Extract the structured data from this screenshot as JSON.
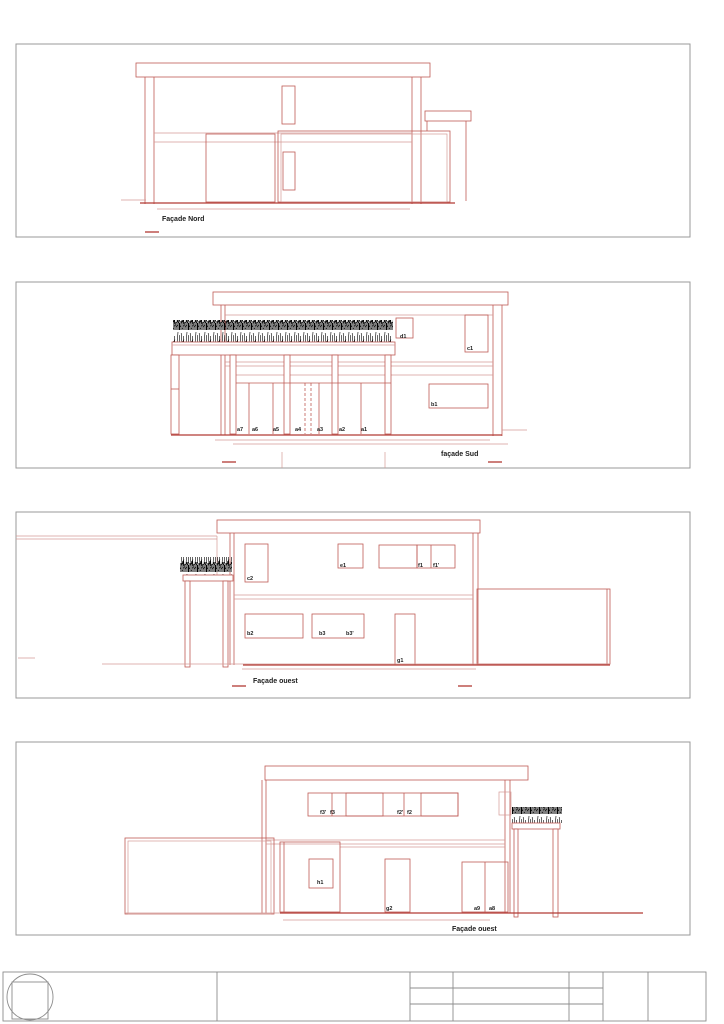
{
  "sheet": {
    "type": "architectural-elevation-drawing",
    "page": "facades"
  },
  "colors": {
    "line-red": "#bf5b55",
    "line-red-light": "#d49a96",
    "line-red-strong": "#b23a34",
    "frame-gray": "#9a9a9a",
    "titleblock-gray": "#8c8c8c",
    "ink": "#1c1c1c",
    "vegetation": "#000000"
  },
  "panels": [
    {
      "title": "Façade Nord"
    },
    {
      "title": "façade Sud",
      "labels": {
        "a": [
          "a7",
          "a6",
          "a5",
          "a4",
          "a3",
          "a2",
          "a1"
        ],
        "d1": "d1",
        "c1": "c1",
        "b1": "b1"
      }
    },
    {
      "title": "Façade ouest",
      "labels": {
        "c2": "c2",
        "e1": "e1",
        "f1": "f1",
        "f1p": "f1'",
        "b2": "b2",
        "b3": "b3",
        "b3p": "b3'",
        "g1": "g1"
      }
    },
    {
      "title": "Façade ouest",
      "labels": {
        "f3p": "f3'",
        "f3": "f3",
        "f2p": "f2'",
        "f2": "f2",
        "h1": "h1",
        "g2": "g2",
        "a9": "a9",
        "a8": "a8"
      }
    }
  ]
}
